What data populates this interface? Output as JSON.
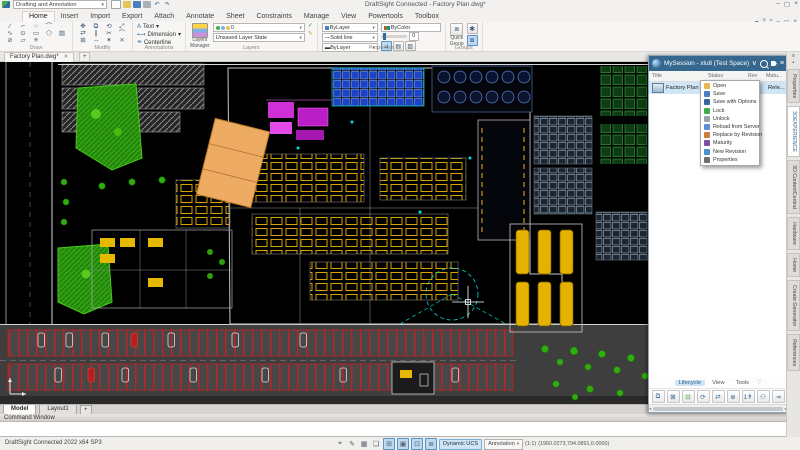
{
  "title_bar": {
    "workspace_selector": "Drafting and Annotation",
    "window_title": "DraftSight Connected - Factory Plan.dwg*"
  },
  "ribbon": {
    "tabs": [
      {
        "label": "Home"
      },
      {
        "label": "Insert"
      },
      {
        "label": "Import"
      },
      {
        "label": "Export"
      },
      {
        "label": "Attach"
      },
      {
        "label": "Annotate"
      },
      {
        "label": "Sheet"
      },
      {
        "label": "Constraints"
      },
      {
        "label": "Manage"
      },
      {
        "label": "View"
      },
      {
        "label": "Powertools"
      },
      {
        "label": "Toolbox"
      }
    ],
    "active_tab": "Home",
    "groups": {
      "draw": "Draw",
      "modify": "Modify",
      "annotations": "Annotations",
      "layers": "Layers",
      "properties": "Properties",
      "groups": "Groups"
    },
    "annotations_tools": {
      "text": "Text",
      "dimension": "Dimension",
      "centerline": "Centerline"
    },
    "layers_tools": {
      "manager_line1": "Layers",
      "manager_line2": "Manager",
      "current_layer": "0",
      "layer_state": "Unsaved Layer State"
    },
    "properties_tools": {
      "line_color": "ByLayer",
      "line_style": "Solid line",
      "line_weight": "ByLayer",
      "hatch_color": "ByColor",
      "transparency": "0"
    },
    "groups_tools": {
      "quick_group_line1": "Quick",
      "quick_group_line2": "Group"
    }
  },
  "document_bar": {
    "tab": "Factory Plan.dwg*"
  },
  "session_panel": {
    "title": "MySession - xlu8 (Test Space) (...",
    "columns": {
      "title": "Title",
      "status": "Status",
      "rev": "Rev",
      "maturity": "Matu..."
    },
    "row": {
      "title": "Factory Plan",
      "rev": "A.1",
      "maturity": "Rele..."
    },
    "context_menu": {
      "items": [
        "Open",
        "Save",
        "Save with Options",
        "Lock",
        "Unlock",
        "Reload from Server",
        "Replace by Revision",
        "Maturity",
        "New Revision",
        "Properties"
      ]
    },
    "bottom_tabs": {
      "lifecycle": "Lifecycle",
      "view": "View",
      "tools": "Tools"
    }
  },
  "side_tabs": {
    "items": [
      "Properties",
      "3DEXPERIENCE",
      "3D ContentCentral",
      "Hardware",
      "Home",
      "Create Generator",
      "References"
    ],
    "active": "3DEXPERIENCE"
  },
  "sheet_bar": {
    "model": "Model",
    "layout1": "Layout1",
    "add_tab": "+"
  },
  "command_window": {
    "title": "Command Window"
  },
  "status_bar": {
    "version": "DraftSight Connected 2022   x64 SP3",
    "dynamic_ucs": "Dynamic UCS",
    "annotation_scale": "Annotation",
    "scale_ratio": "(1:1)",
    "coordinates": "(1960.0273,794.0891,0.0000)"
  },
  "colors": {
    "accent_blue": "#36688f",
    "selection_blue": "#cfe6f7",
    "canvas_bg": "#000000",
    "machine_yellow": "#f0b400",
    "equipment_magenta": "#cf2fd6",
    "grass_green": "#2f9e12"
  }
}
